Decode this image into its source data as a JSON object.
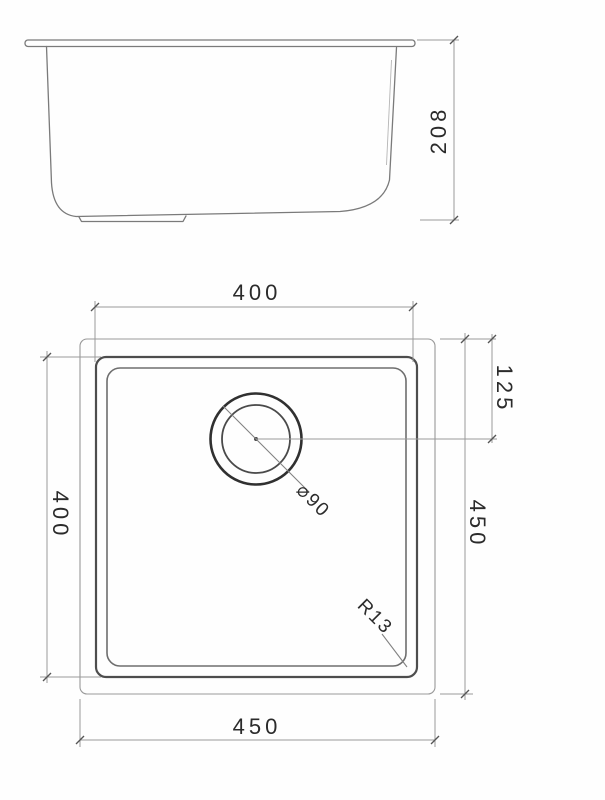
{
  "colors": {
    "background": "#fefefe",
    "line_main": "#7a7a7a",
    "line_dark": "#4d4d4d",
    "dimension_line": "#9a9a9a",
    "text": "#2b2b2b"
  },
  "side_view": {
    "height_dim": "208"
  },
  "plan_view": {
    "inner_width_dim": "400",
    "inner_height_dim": "400",
    "outer_height_dim": "450",
    "outer_width_dim": "450",
    "drain_offset_dim": "125",
    "drain_diameter_label": "⌀90",
    "corner_radius_label": "R13"
  }
}
